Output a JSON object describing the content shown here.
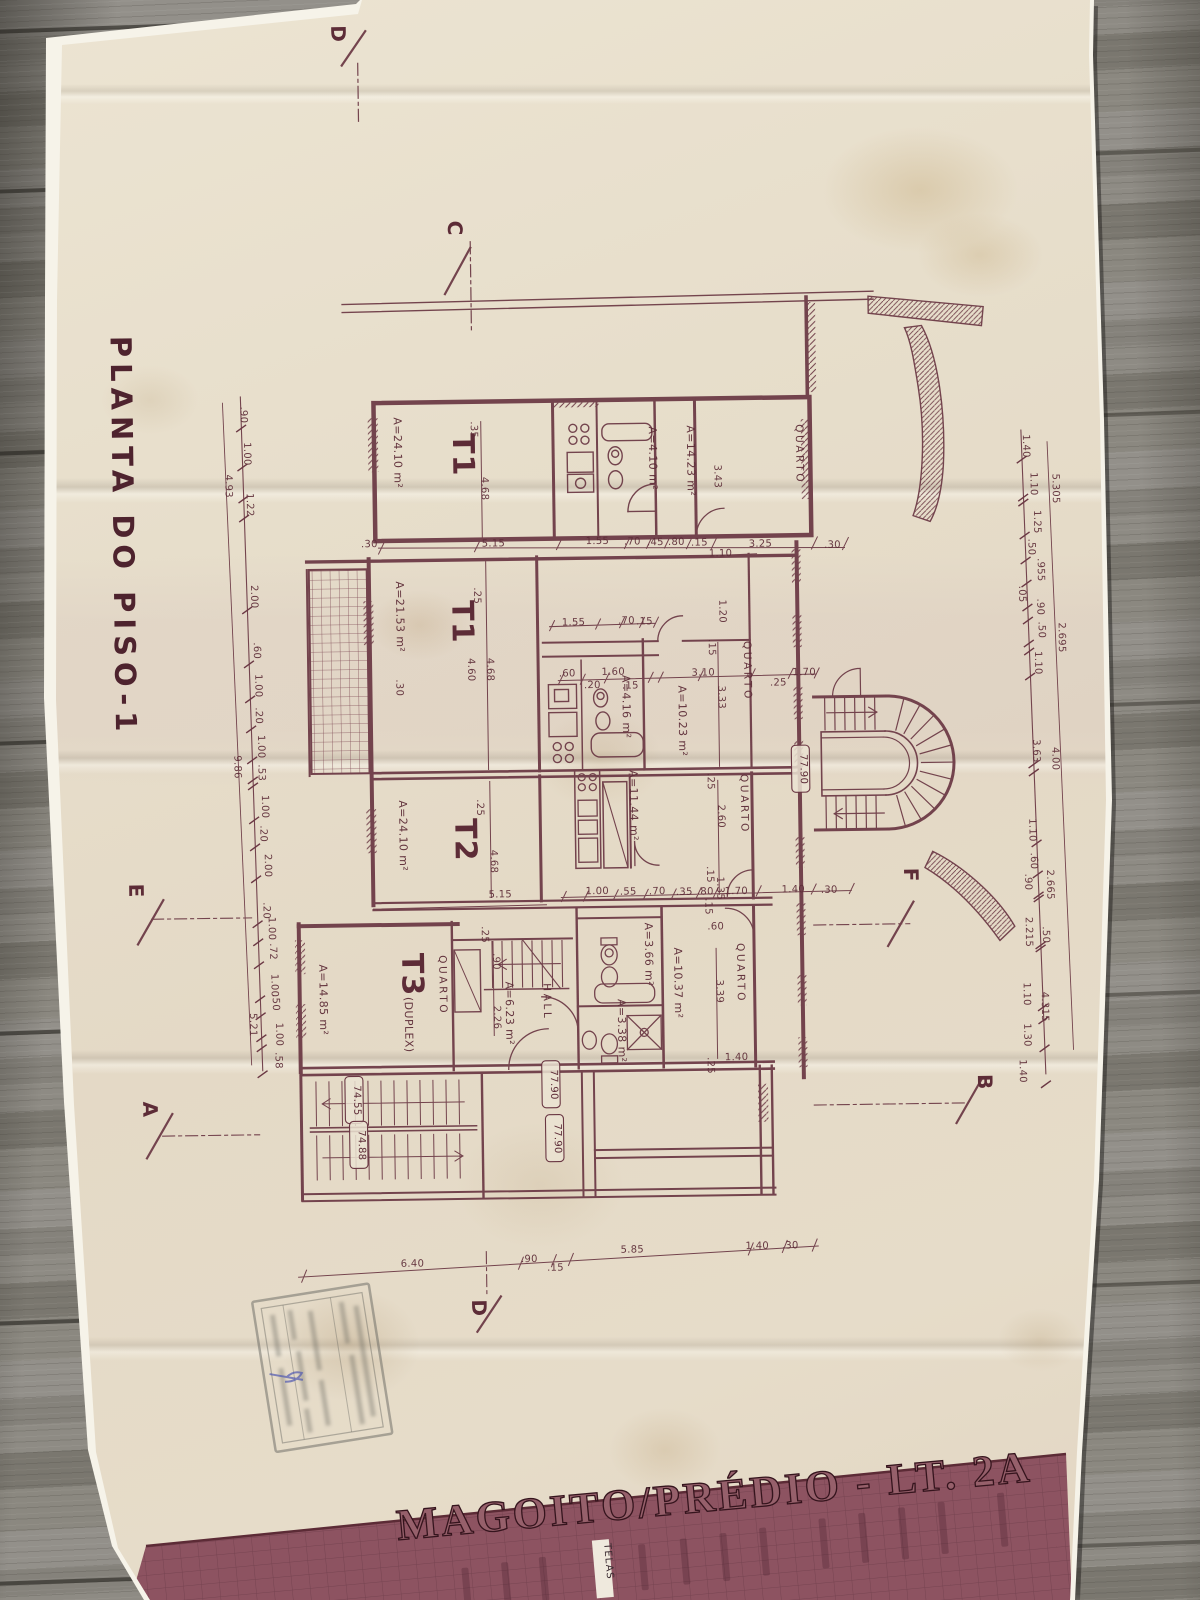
{
  "colors": {
    "ink": "#5d2c37",
    "paper": "#e7decb",
    "band": "#8d5361",
    "wood": "#8a8781"
  },
  "title_block": {
    "title": "MAGOITO/PRÉDIO - LT. 2A",
    "strip_label": "TELAS"
  },
  "handwriting": {
    "blue_mark": "D"
  },
  "plan_texts": [
    {
      "t": "PLANTA DO PISO-1",
      "x": 117,
      "y": 530,
      "r": 90,
      "cls": "title"
    },
    {
      "t": "D",
      "x": 342,
      "y": 30,
      "r": 90,
      "cls": "marker"
    },
    {
      "t": "C",
      "x": 456,
      "y": 226,
      "r": 90,
      "cls": "marker"
    },
    {
      "t": "E",
      "x": 128,
      "y": 884,
      "r": 90,
      "cls": "marker"
    },
    {
      "t": "F",
      "x": 903,
      "y": 879,
      "r": 90,
      "cls": "marker"
    },
    {
      "t": "A",
      "x": 139,
      "y": 1103,
      "r": 90,
      "cls": "marker"
    },
    {
      "t": "B",
      "x": 974,
      "y": 1087,
      "r": 90,
      "cls": "marker"
    },
    {
      "t": "D",
      "x": 465,
      "y": 1306,
      "r": 90,
      "cls": "marker"
    },
    {
      "t": "T1",
      "x": 458,
      "y": 453,
      "r": 90,
      "cls": "big"
    },
    {
      "t": "T1",
      "x": 455,
      "y": 620,
      "r": 90,
      "cls": "big"
    },
    {
      "t": "T2",
      "x": 455,
      "y": 838,
      "r": 90,
      "cls": "big"
    },
    {
      "t": "T3",
      "x": 400,
      "y": 972,
      "r": 90,
      "cls": "big"
    },
    {
      "t": "(DUPLEX)",
      "x": 402,
      "y": 1022,
      "r": 90,
      "cls": "area"
    },
    {
      "t": "QUARTO",
      "x": 801,
      "y": 457,
      "r": 90,
      "cls": "room"
    },
    {
      "t": "QUARTO",
      "x": 746,
      "y": 673,
      "r": 90,
      "cls": "room"
    },
    {
      "t": "QUARTO",
      "x": 741,
      "y": 806,
      "r": 90,
      "cls": "room"
    },
    {
      "t": "QUARTO",
      "x": 437,
      "y": 983,
      "r": 90,
      "cls": "room"
    },
    {
      "t": "QUARTO",
      "x": 735,
      "y": 975,
      "r": 90,
      "cls": "room"
    },
    {
      "t": "HALL",
      "x": 541,
      "y": 1001,
      "r": 90,
      "cls": "room"
    },
    {
      "t": "A=24.10 m²",
      "x": 399,
      "y": 450,
      "r": 90,
      "cls": "area"
    },
    {
      "t": "A=14.23 m²",
      "x": 692,
      "y": 462,
      "r": 90,
      "cls": "area"
    },
    {
      "t": "A=4.10 m²",
      "x": 654,
      "y": 459,
      "r": 90,
      "cls": "area"
    },
    {
      "t": "A=21.53 m²",
      "x": 399,
      "y": 614,
      "r": 90,
      "cls": "area"
    },
    {
      "t": "A=4.16 m²",
      "x": 624,
      "y": 707,
      "r": 90,
      "cls": "area"
    },
    {
      "t": "A=10.23 m²",
      "x": 680,
      "y": 722,
      "r": 90,
      "cls": "area"
    },
    {
      "t": "A=24.10 m²",
      "x": 399,
      "y": 833,
      "r": 90,
      "cls": "area"
    },
    {
      "t": "A=11.44 m²",
      "x": 630,
      "y": 806,
      "r": 90,
      "cls": "area"
    },
    {
      "t": "A=14.85 m²",
      "x": 317,
      "y": 996,
      "r": 90,
      "cls": "area"
    },
    {
      "t": "A=6.23 m²",
      "x": 503,
      "y": 1012,
      "r": 90,
      "cls": "area"
    },
    {
      "t": "A=3.66 m²",
      "x": 643,
      "y": 955,
      "r": 90,
      "cls": "area"
    },
    {
      "t": "A=3.38 m²",
      "x": 615,
      "y": 1031,
      "r": 90,
      "cls": "area"
    },
    {
      "t": "A=10.37 m²",
      "x": 672,
      "y": 984,
      "r": 90,
      "cls": "area"
    },
    {
      "t": "77.90",
      "x": 801,
      "y": 772,
      "r": 90,
      "cls": "elev"
    },
    {
      "t": "77.90",
      "x": 547,
      "y": 1084,
      "r": 90,
      "cls": "elev"
    },
    {
      "t": "77.90",
      "x": 550,
      "y": 1138,
      "r": 90,
      "cls": "elev"
    },
    {
      "t": "74.55",
      "x": 350,
      "y": 1097,
      "r": 90,
      "cls": "elev"
    },
    {
      "t": "74.88",
      "x": 354,
      "y": 1142,
      "r": 90,
      "cls": "elev"
    },
    {
      "t": ".90",
      "x": 246,
      "y": 410,
      "r": 90,
      "cls": "dim"
    },
    {
      "t": "1.00",
      "x": 249,
      "y": 449,
      "r": 90,
      "cls": "dim"
    },
    {
      "t": "1.22",
      "x": 251,
      "y": 500,
      "r": 90,
      "cls": "dim"
    },
    {
      "t": "2.00",
      "x": 254,
      "y": 592,
      "r": 90,
      "cls": "dim"
    },
    {
      "t": ".60",
      "x": 256,
      "y": 646,
      "r": 90,
      "cls": "dim"
    },
    {
      "t": "1.00",
      "x": 257,
      "y": 681,
      "r": 90,
      "cls": "dim"
    },
    {
      "t": ".20",
      "x": 257,
      "y": 711,
      "r": 90,
      "cls": "dim"
    },
    {
      "t": "1.00",
      "x": 259,
      "y": 742,
      "r": 90,
      "cls": "dim"
    },
    {
      "t": ".53",
      "x": 259,
      "y": 768,
      "r": 90,
      "cls": "dim"
    },
    {
      "t": "1.00",
      "x": 262,
      "y": 802,
      "r": 90,
      "cls": "dim"
    },
    {
      "t": ".20",
      "x": 260,
      "y": 829,
      "r": 90,
      "cls": "dim"
    },
    {
      "t": "2.00",
      "x": 264,
      "y": 861,
      "r": 90,
      "cls": "dim"
    },
    {
      "t": ".20",
      "x": 262,
      "y": 906,
      "r": 90,
      "cls": "dim"
    },
    {
      "t": "1.00",
      "x": 267,
      "y": 924,
      "r": 90,
      "cls": "dim"
    },
    {
      "t": ".72",
      "x": 268,
      "y": 947,
      "r": 90,
      "cls": "dim"
    },
    {
      "t": "1.00",
      "x": 269,
      "y": 981,
      "r": 90,
      "cls": "dim"
    },
    {
      "t": ".50",
      "x": 270,
      "y": 998,
      "r": 90,
      "cls": "dim"
    },
    {
      "t": "1.00",
      "x": 273,
      "y": 1030,
      "r": 90,
      "cls": "dim"
    },
    {
      "t": ".58",
      "x": 272,
      "y": 1056,
      "r": 90,
      "cls": "dim"
    },
    {
      "t": "4.93",
      "x": 230,
      "y": 481,
      "r": 90,
      "cls": "dim"
    },
    {
      "t": "9.86",
      "x": 235,
      "y": 762,
      "r": 90,
      "cls": "dim"
    },
    {
      "t": "5.21",
      "x": 247,
      "y": 1020,
      "r": 90,
      "cls": "dim"
    },
    {
      "t": "1.40",
      "x": 1028,
      "y": 452,
      "r": 90,
      "cls": "dim"
    },
    {
      "t": "1.10",
      "x": 1035,
      "y": 490,
      "r": 90,
      "cls": "dim"
    },
    {
      "t": "1.25",
      "x": 1038,
      "y": 528,
      "r": 90,
      "cls": "dim"
    },
    {
      "t": ".50",
      "x": 1032,
      "y": 553,
      "r": 90,
      "cls": "dim"
    },
    {
      "t": ".955",
      "x": 1041,
      "y": 576,
      "r": 90,
      "cls": "dim"
    },
    {
      "t": ".05",
      "x": 1022,
      "y": 600,
      "r": 90,
      "cls": "dim"
    },
    {
      "t": ".90",
      "x": 1040,
      "y": 613,
      "r": 90,
      "cls": "dim"
    },
    {
      "t": ".50",
      "x": 1041,
      "y": 636,
      "r": 90,
      "cls": "dim"
    },
    {
      "t": "1.10",
      "x": 1037,
      "y": 669,
      "r": 90,
      "cls": "dim"
    },
    {
      "t": "5.305",
      "x": 1057,
      "y": 495,
      "r": 90,
      "cls": "dim"
    },
    {
      "t": "2.695",
      "x": 1061,
      "y": 644,
      "r": 90,
      "cls": "dim"
    },
    {
      "t": "3.63",
      "x": 1034,
      "y": 757,
      "r": 90,
      "cls": "dim"
    },
    {
      "t": "4.00",
      "x": 1053,
      "y": 765,
      "r": 90,
      "cls": "dim"
    },
    {
      "t": "1.10",
      "x": 1029,
      "y": 836,
      "r": 90,
      "cls": "dim"
    },
    {
      "t": ".60",
      "x": 1030,
      "y": 867,
      "r": 90,
      "cls": "dim"
    },
    {
      "t": ".90",
      "x": 1024,
      "y": 888,
      "r": 90,
      "cls": "dim"
    },
    {
      "t": "2.665",
      "x": 1046,
      "y": 891,
      "r": 90,
      "cls": "dim"
    },
    {
      "t": "2.215",
      "x": 1024,
      "y": 938,
      "r": 90,
      "cls": "dim"
    },
    {
      "t": ".50",
      "x": 1041,
      "y": 941,
      "r": 90,
      "cls": "dim"
    },
    {
      "t": "1.10",
      "x": 1021,
      "y": 1000,
      "r": 90,
      "cls": "dim"
    },
    {
      "t": "4.315",
      "x": 1039,
      "y": 1013,
      "r": 90,
      "cls": "dim"
    },
    {
      "t": "1.30",
      "x": 1021,
      "y": 1041,
      "r": 90,
      "cls": "dim"
    },
    {
      "t": "1.40",
      "x": 1016,
      "y": 1077,
      "r": 90,
      "cls": "dim"
    },
    {
      "t": ".30",
      "x": 373,
      "y": 544,
      "r": 0,
      "cls": "dim"
    },
    {
      "t": "5.15",
      "x": 497,
      "y": 545,
      "r": 0,
      "cls": "dim"
    },
    {
      "t": "1.55",
      "x": 601,
      "y": 544,
      "r": 0,
      "cls": "dim"
    },
    {
      "t": ".70",
      "x": 636,
      "y": 545,
      "r": 0,
      "cls": "dim"
    },
    {
      "t": ".45",
      "x": 659,
      "y": 546,
      "r": 0,
      "cls": "dim"
    },
    {
      "t": ".80",
      "x": 680,
      "y": 546,
      "r": 0,
      "cls": "dim"
    },
    {
      "t": ".15",
      "x": 703,
      "y": 547,
      "r": 0,
      "cls": "dim"
    },
    {
      "t": "3.25",
      "x": 764,
      "y": 549,
      "r": 0,
      "cls": "dim"
    },
    {
      "t": ".30",
      "x": 836,
      "y": 551,
      "r": 0,
      "cls": "dim"
    },
    {
      "t": "1.10",
      "x": 724,
      "y": 558,
      "r": 0,
      "cls": "dim"
    },
    {
      "t": ".35",
      "x": 476,
      "y": 428,
      "r": 90,
      "cls": "dim"
    },
    {
      "t": "4.68",
      "x": 486,
      "y": 487,
      "r": 90,
      "cls": "dim"
    },
    {
      "t": "3.43",
      "x": 719,
      "y": 478,
      "r": 90,
      "cls": "dim"
    },
    {
      "t": ".25",
      "x": 477,
      "y": 594,
      "r": 90,
      "cls": "dim"
    },
    {
      "t": "4.60",
      "x": 470,
      "y": 668,
      "r": 90,
      "cls": "dim"
    },
    {
      "t": "4.68",
      "x": 489,
      "y": 668,
      "r": 90,
      "cls": "dim"
    },
    {
      "t": ".30",
      "x": 398,
      "y": 685,
      "r": 90,
      "cls": "dim"
    },
    {
      "t": "1.20",
      "x": 722,
      "y": 613,
      "r": 90,
      "cls": "dim"
    },
    {
      "t": ".15",
      "x": 711,
      "y": 649,
      "r": 90,
      "cls": "dim"
    },
    {
      "t": "3.33",
      "x": 720,
      "y": 699,
      "r": 90,
      "cls": "dim"
    },
    {
      "t": ".25",
      "x": 477,
      "y": 806,
      "r": 90,
      "cls": "dim"
    },
    {
      "t": "4.68",
      "x": 490,
      "y": 860,
      "r": 90,
      "cls": "dim"
    },
    {
      "t": "2.60",
      "x": 718,
      "y": 818,
      "r": 90,
      "cls": "dim"
    },
    {
      "t": ".15",
      "x": 706,
      "y": 876,
      "r": 90,
      "cls": "dim"
    },
    {
      "t": "1.35",
      "x": 716,
      "y": 890,
      "r": 90,
      "cls": "dim"
    },
    {
      "t": ".25",
      "x": 708,
      "y": 783,
      "r": 90,
      "cls": "dim"
    },
    {
      "t": ".25",
      "x": 480,
      "y": 933,
      "r": 90,
      "cls": "dim"
    },
    {
      "t": ".90",
      "x": 491,
      "y": 960,
      "r": 90,
      "cls": "dim"
    },
    {
      "t": "2.26",
      "x": 491,
      "y": 1016,
      "r": 90,
      "cls": "dim"
    },
    {
      "t": "3.39",
      "x": 714,
      "y": 993,
      "r": 90,
      "cls": "dim"
    },
    {
      "t": ".15",
      "x": 704,
      "y": 908,
      "r": 90,
      "cls": "dim"
    },
    {
      "t": ".25",
      "x": 704,
      "y": 1067,
      "r": 90,
      "cls": "dim"
    },
    {
      "t": "1.55",
      "x": 576,
      "y": 625,
      "r": 0,
      "cls": "dim"
    },
    {
      "t": ".70",
      "x": 629,
      "y": 624,
      "r": 0,
      "cls": "dim"
    },
    {
      "t": ".15",
      "x": 647,
      "y": 625,
      "r": 0,
      "cls": "dim"
    },
    {
      "t": ".60",
      "x": 569,
      "y": 676,
      "r": 0,
      "cls": "dim"
    },
    {
      "t": "1.60",
      "x": 615,
      "y": 675,
      "r": 0,
      "cls": "dim"
    },
    {
      "t": ".20",
      "x": 594,
      "y": 688,
      "r": 0,
      "cls": "dim"
    },
    {
      "t": ".15",
      "x": 632,
      "y": 689,
      "r": 0,
      "cls": "dim"
    },
    {
      "t": "3.10",
      "x": 705,
      "y": 677,
      "r": 0,
      "cls": "dim"
    },
    {
      "t": "1.70",
      "x": 806,
      "y": 678,
      "r": 0,
      "cls": "dim"
    },
    {
      "t": ".25",
      "x": 780,
      "y": 688,
      "r": 0,
      "cls": "dim"
    },
    {
      "t": "5.15",
      "x": 499,
      "y": 896,
      "r": 0,
      "cls": "dim"
    },
    {
      "t": "1.00",
      "x": 596,
      "y": 894,
      "r": 0,
      "cls": "dim"
    },
    {
      "t": ".55",
      "x": 627,
      "y": 895,
      "r": 0,
      "cls": "dim"
    },
    {
      "t": ".70",
      "x": 656,
      "y": 895,
      "r": 0,
      "cls": "dim"
    },
    {
      "t": ".35",
      "x": 683,
      "y": 896,
      "r": 0,
      "cls": "dim"
    },
    {
      "t": ".80",
      "x": 704,
      "y": 896,
      "r": 0,
      "cls": "dim"
    },
    {
      "t": "1.70",
      "x": 735,
      "y": 896,
      "r": 0,
      "cls": "dim"
    },
    {
      "t": "1.40",
      "x": 792,
      "y": 895,
      "r": 0,
      "cls": "dim"
    },
    {
      "t": ".30",
      "x": 828,
      "y": 896,
      "r": 0,
      "cls": "dim"
    },
    {
      "t": ".60",
      "x": 714,
      "y": 931,
      "r": 0,
      "cls": "dim"
    },
    {
      "t": "1.40",
      "x": 733,
      "y": 1062,
      "r": 0,
      "cls": "dim"
    },
    {
      "t": "6.40",
      "x": 406,
      "y": 1264,
      "r": 0,
      "cls": "dim"
    },
    {
      "t": ".90",
      "x": 523,
      "y": 1261,
      "r": 0,
      "cls": "dim"
    },
    {
      "t": ".15",
      "x": 549,
      "y": 1270,
      "r": 0,
      "cls": "dim"
    },
    {
      "t": "5.85",
      "x": 626,
      "y": 1253,
      "r": 0,
      "cls": "dim"
    },
    {
      "t": "1.40",
      "x": 751,
      "y": 1251,
      "r": 0,
      "cls": "dim"
    },
    {
      "t": ".30",
      "x": 784,
      "y": 1251,
      "r": 0,
      "cls": "dim"
    },
    {
      "t": "D",
      "x": 1127,
      "y": 1413,
      "r": 90,
      "cls": "handblue"
    }
  ]
}
